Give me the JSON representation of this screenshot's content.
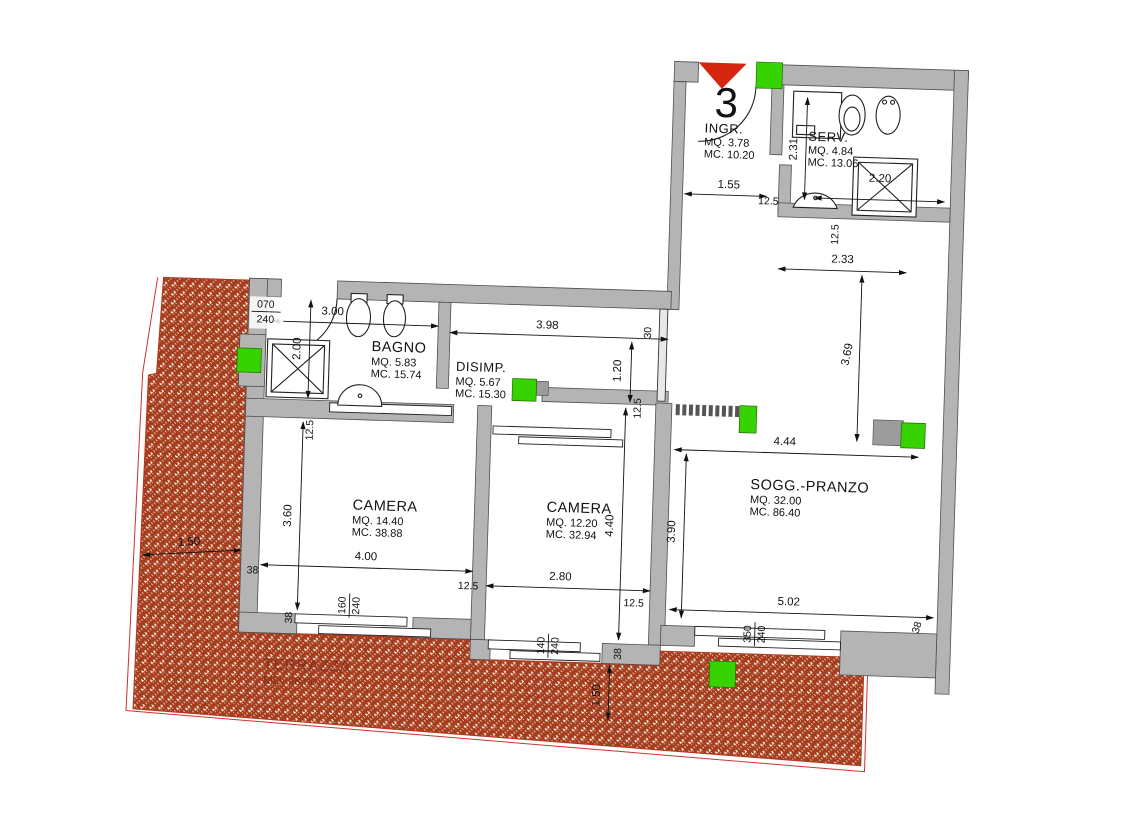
{
  "unit": {
    "number": "3"
  },
  "rooms": {
    "ingr": {
      "name": "INGR.",
      "mq": "MQ.  3.78",
      "mc": "MC. 10.20"
    },
    "serv": {
      "name": "SERV.",
      "mq": "MQ.  4.84",
      "mc": "MC. 13.06"
    },
    "bagno": {
      "name": "BAGNO",
      "mq": "MQ.  5.83",
      "mc": "MC. 15.74"
    },
    "disimp": {
      "name": "DISIMP.",
      "mq": "MQ.  5.67",
      "mc": "MC. 15.30"
    },
    "camera1": {
      "name": "CAMERA",
      "mq": "MQ. 14.40",
      "mc": "MC. 38.88"
    },
    "camera2": {
      "name": "CAMERA",
      "mq": "MQ. 12.20",
      "mc": "MC. 32.94"
    },
    "sogg": {
      "name": "SOGG.-PRANZO",
      "mq": "MQ. 32.00",
      "mc": "MC. 86.40"
    },
    "terrazza": {
      "name": "TERRAZZA",
      "mq": "MQ. 28.00"
    }
  },
  "dims": {
    "ingr_width": "1.55",
    "ingr_wall": "12.5",
    "serv_depth": "2.31",
    "serv_width": "2.20",
    "serv_wall": "12.5",
    "passage_width": "2.33",
    "passage_depth": "3.69",
    "sogg_top_width": "4.44",
    "sogg_depth": "3.90",
    "sogg_bottom_width": "5.02",
    "sogg_window_w": "350",
    "sogg_window_h": "240",
    "sogg_wall_bottom": "38",
    "bagno_width": "3.00",
    "bagno_depth": "2.00",
    "bagno_wall": "12.5",
    "corridor_length": "3.98",
    "corridor_wall": "30",
    "corridor_width": "1.20",
    "door_w": "070",
    "door_h": "240",
    "camera1_depth": "3.60",
    "camera1_width": "4.00",
    "camera1_wall_left": "38",
    "camera1_wall_right": "12.5",
    "camera1_window_w": "160",
    "camera1_window_h": "240",
    "camera1_wall_bottom": "38",
    "camera2_wall_top": "12.5",
    "camera2_depth": "4.40",
    "camera2_width": "2.80",
    "camera2_wall_right": "12.5",
    "camera2_window_w": "140",
    "camera2_window_h": "240",
    "camera2_wall_bottom": "38",
    "terrace_width_left": "1.50",
    "terrace_width_bottom": "1.50"
  },
  "colors": {
    "wall_fill": "#b4b4b4",
    "hatch_red": "#a63c1e",
    "hatch_bg": "#f8efdd",
    "boundary_red": "#c03028",
    "marker_green": "#36d300",
    "entrance_arrow_red": "#d6250e",
    "terrace_text": "#7e2c14"
  }
}
